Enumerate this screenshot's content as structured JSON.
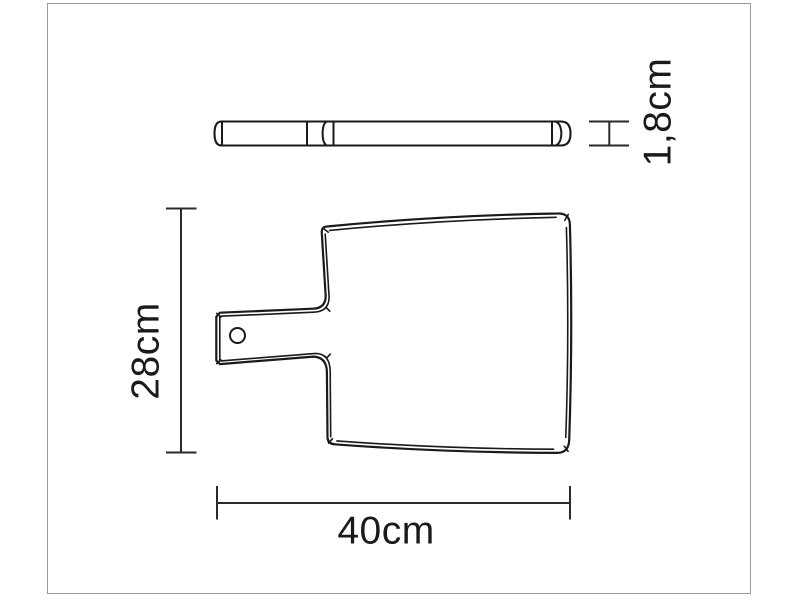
{
  "page": {
    "background_color": "#ffffff",
    "frame_color": "#9a9a9a"
  },
  "drawing": {
    "subject": "cutting-board-technical-drawing",
    "line_color": "#1a1a1a",
    "views": {
      "side_view": "board-thickness-profile",
      "top_view": "board-with-handle-and-hole"
    },
    "labels": {
      "width": "40cm",
      "height": "28cm",
      "thickness": "1,8cm"
    }
  }
}
